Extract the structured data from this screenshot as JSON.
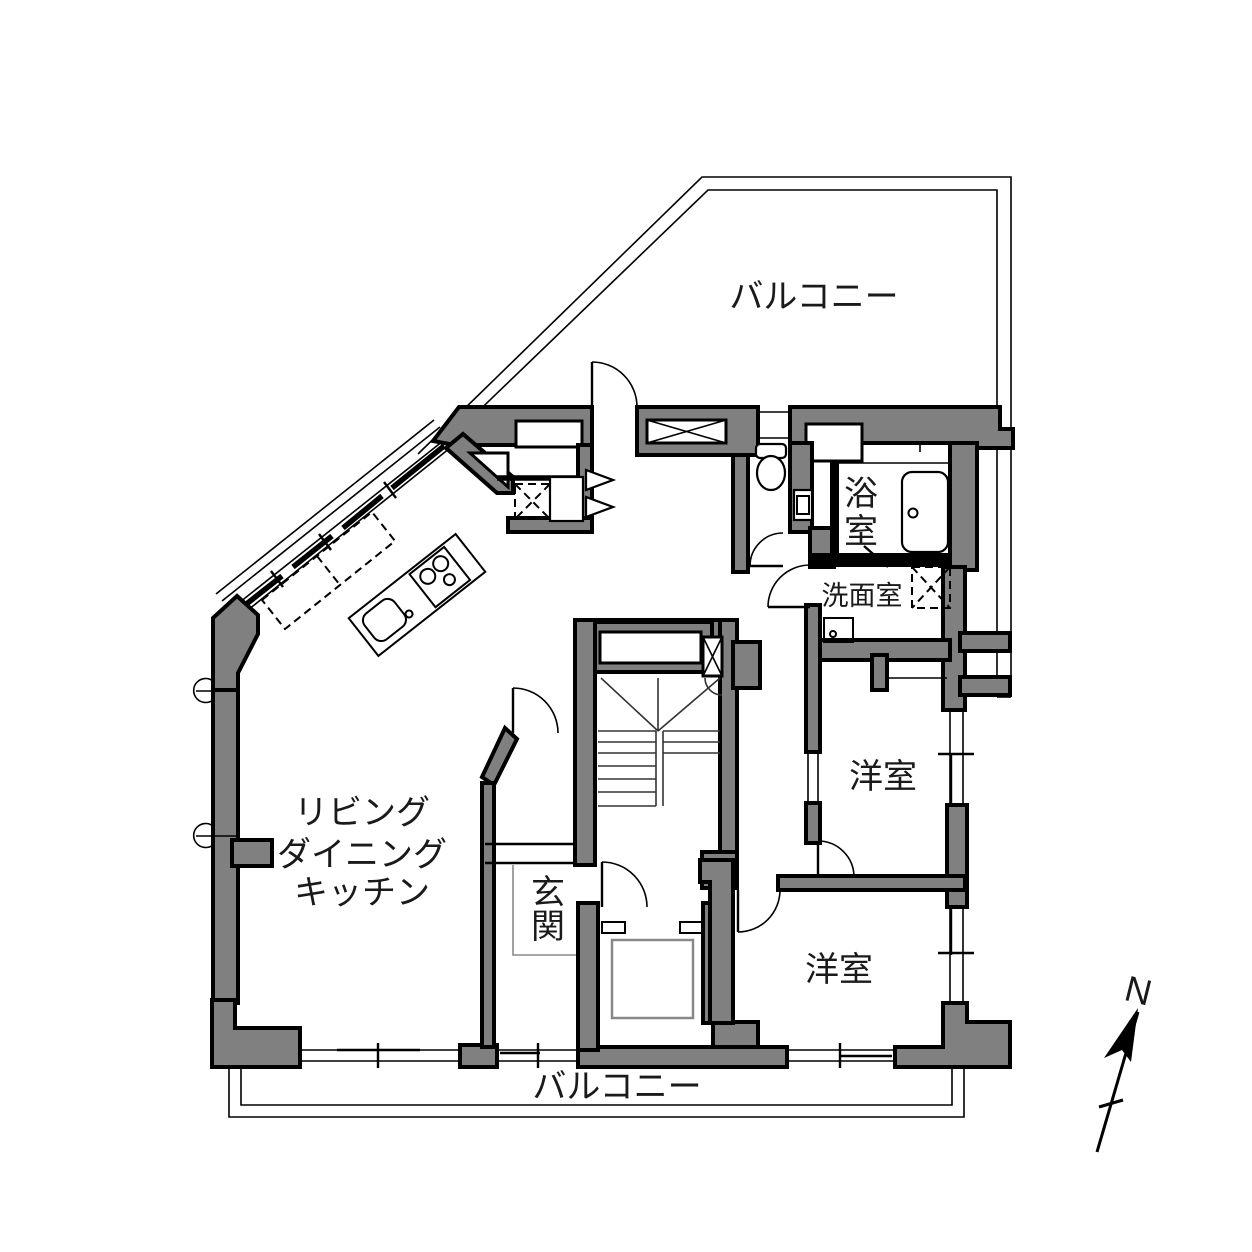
{
  "diagram_type": "floor-plan",
  "colors": {
    "wall_fill": "#808080",
    "wall_stroke": "#000000",
    "line": "#000000",
    "stair_line": "#333333",
    "soft_line": "#8a8a8a",
    "text": "#1a1a1a",
    "bg": "#ffffff",
    "elevator_car": "#888888"
  },
  "labels": {
    "balcony_top": "バルコニー",
    "balcony_bottom": "バルコニー",
    "bathroom_chars": [
      "浴",
      "室"
    ],
    "washroom": "洗面室",
    "western_room_upper": "洋室",
    "western_room_lower": "洋室",
    "ldk_lines": [
      "リビング",
      "ダイニング",
      "キッチン"
    ],
    "entrance_chars": [
      "玄",
      "関"
    ],
    "compass_north": "N"
  }
}
